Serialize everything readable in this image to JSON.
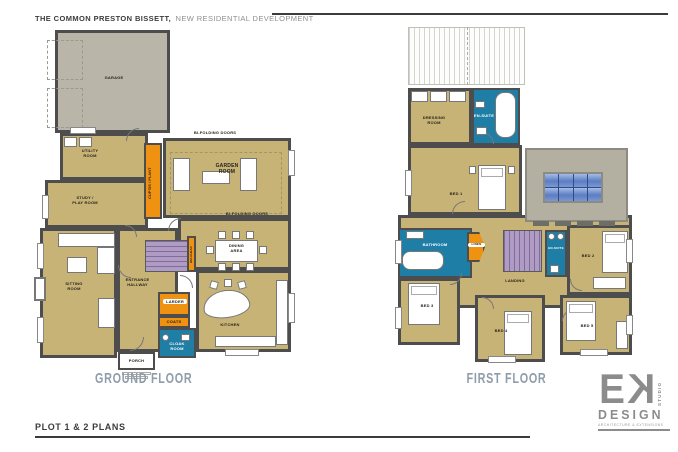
{
  "header": {
    "project": "THE COMMON PRESTON BISSETT,",
    "subtitle": "NEW RESIDENTIAL DEVELOPMENT"
  },
  "footer": {
    "sheet_title": "PLOT 1 & 2  PLANS"
  },
  "logo": {
    "letter_e": "E",
    "letter_k": "K",
    "studio": "STUDIO",
    "design": "DESIGN",
    "tagline": "ARCHITECTURE & EXTENSIONS"
  },
  "ground_floor": {
    "title": "GROUND FLOOR",
    "rooms": {
      "garage": "GARAGE",
      "utility": "UTILITY\nROOM",
      "study": "STUDY /\nPLAY ROOM",
      "cupboards": "CUP'DS / PLANT",
      "garden": "GARDEN\nROOM",
      "dining": "DINING\nAREA",
      "kitchen": "KITCHEN",
      "hallway": "ENTRANCE\nHALLWAY",
      "sitting": "SITTING\nROOM",
      "larder": "LARDER",
      "coats": "COATS",
      "cloak": "CLOAK\nROOM",
      "porch": "PORCH",
      "bulkhead": "BULKHEAD",
      "bifold_top": "BI-FOLDING DOORS",
      "bifold_bottom": "BI-FOLDING DOORS"
    }
  },
  "first_floor": {
    "title": "FIRST FLOOR",
    "rooms": {
      "dressing": "DRESSING\nROOM",
      "ensuite1": "EN-SUITE",
      "bed1": "BED 1",
      "bathroom": "BATHROOM",
      "linen": "LINEN",
      "landing": "LANDING",
      "ensuite2": "EN-SUITE",
      "bed2": "BED 2",
      "bed3": "BED 3",
      "bed4": "BED 4",
      "bed5": "BED 5"
    }
  },
  "colors": {
    "floor_tan": "#c8b377",
    "garage_gray": "#b9b6a9",
    "wet_room_teal": "#1f7ea6",
    "storage_orange": "#ef9211",
    "stairs_purple": "#b09bc4",
    "skylight_blue": "#5b7dc2",
    "wall": "#4d4d4d",
    "floor_title_gray": "#8e9dab"
  }
}
